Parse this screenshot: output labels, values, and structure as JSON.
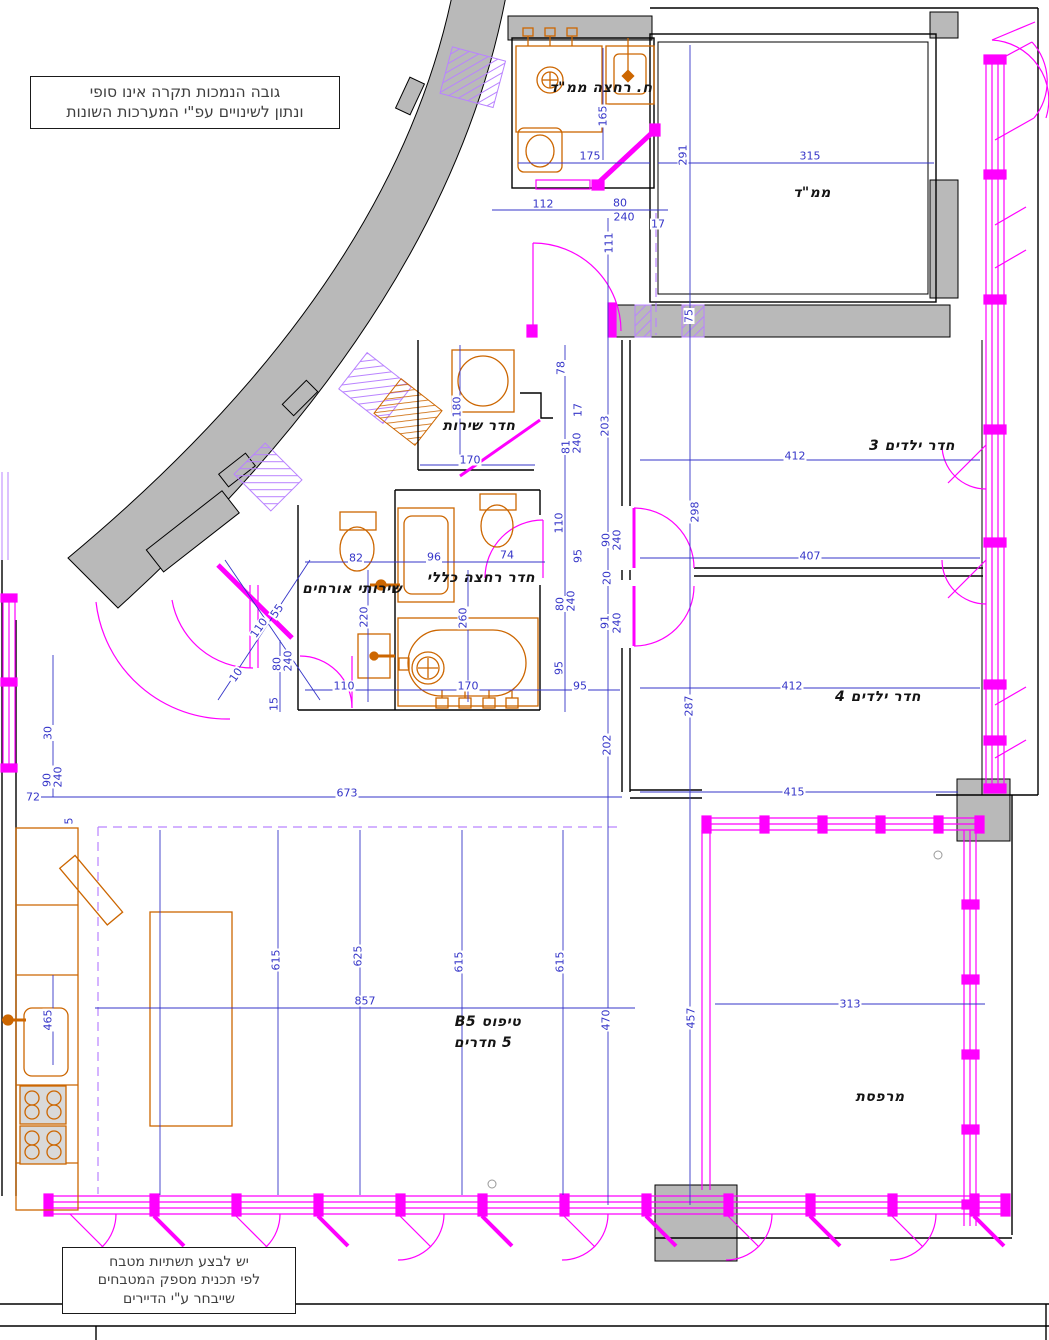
{
  "drawing": {
    "type_label_line1": "טיפוס B5",
    "type_label_line2": "5 חדרים"
  },
  "colors": {
    "dimension_blue": "#3535c8",
    "wall_grey": "#b9b9b9",
    "fixture_orange": "#cc6600",
    "window_magenta": "#ff00ff",
    "hatch_violet": "#b983ff"
  },
  "notes": {
    "ceiling_note": {
      "lines": [
        "גובה הנמכות תקרה אינו סופי",
        "ונתון לשינויים עפ\"י המערכות השונות"
      ]
    },
    "kitchen_note": {
      "lines": [
        "יש לבצע תשתיות מטבח",
        "לפי תכנית מספק המטבחים",
        "שייבחר ע\"י הדיירים"
      ]
    }
  },
  "room_labels": [
    {
      "id": "bath-mamad",
      "label": "ח. רחצה ממ\"ד",
      "x": 601,
      "y": 88
    },
    {
      "id": "mamad",
      "label": "ממ\"ד",
      "x": 812,
      "y": 193
    },
    {
      "id": "service",
      "label": "חדר שירות",
      "x": 479,
      "y": 426
    },
    {
      "id": "kids3",
      "label": "חדר ילדים 3",
      "x": 912,
      "y": 446
    },
    {
      "id": "guest-wc",
      "label": "שירותי אורחים",
      "x": 352,
      "y": 589
    },
    {
      "id": "bath-main",
      "label": "חדר רחצה כללי",
      "x": 481,
      "y": 578
    },
    {
      "id": "kids4",
      "label": "חדר ילדים 4",
      "x": 878,
      "y": 697
    },
    {
      "id": "type-1",
      "label": "טיפוס B5",
      "x": 488,
      "y": 1022
    },
    {
      "id": "type-2",
      "label": "5 חדרים",
      "x": 483,
      "y": 1043
    },
    {
      "id": "balcony",
      "label": "מרפסת",
      "x": 880,
      "y": 1097
    }
  ],
  "dimensions": [
    {
      "t": "165",
      "x": 603,
      "y": 116,
      "r": -90
    },
    {
      "t": "175",
      "x": 590,
      "y": 156
    },
    {
      "t": "291",
      "x": 683,
      "y": 155,
      "r": -90
    },
    {
      "t": "315",
      "x": 810,
      "y": 156
    },
    {
      "t": "112",
      "x": 543,
      "y": 204
    },
    {
      "t": "80",
      "x": 620,
      "y": 203
    },
    {
      "t": "240",
      "x": 624,
      "y": 217
    },
    {
      "t": "17",
      "x": 658,
      "y": 224
    },
    {
      "t": "111",
      "x": 609,
      "y": 243,
      "r": -90
    },
    {
      "t": "75",
      "x": 689,
      "y": 316,
      "r": -90
    },
    {
      "t": "78",
      "x": 561,
      "y": 368,
      "r": -90
    },
    {
      "t": "17",
      "x": 578,
      "y": 410,
      "r": -90
    },
    {
      "t": "180",
      "x": 457,
      "y": 407,
      "r": -90
    },
    {
      "t": "203",
      "x": 605,
      "y": 426,
      "r": -90
    },
    {
      "t": "81",
      "x": 566,
      "y": 447,
      "r": -90
    },
    {
      "t": "240",
      "x": 577,
      "y": 443,
      "r": -90
    },
    {
      "t": "170",
      "x": 470,
      "y": 460
    },
    {
      "t": "412",
      "x": 795,
      "y": 456
    },
    {
      "t": "298",
      "x": 695,
      "y": 512,
      "r": -90
    },
    {
      "t": "110",
      "x": 559,
      "y": 523,
      "r": -90
    },
    {
      "t": "90",
      "x": 606,
      "y": 540,
      "r": -90
    },
    {
      "t": "240",
      "x": 617,
      "y": 540,
      "r": -90
    },
    {
      "t": "95",
      "x": 578,
      "y": 556,
      "r": -90
    },
    {
      "t": "20",
      "x": 607,
      "y": 578,
      "r": -90
    },
    {
      "t": "80",
      "x": 560,
      "y": 604,
      "r": -90
    },
    {
      "t": "240",
      "x": 571,
      "y": 601,
      "r": -90
    },
    {
      "t": "91",
      "x": 605,
      "y": 622,
      "r": -90
    },
    {
      "t": "240",
      "x": 617,
      "y": 623,
      "r": -90
    },
    {
      "t": "95",
      "x": 559,
      "y": 668,
      "r": -90
    },
    {
      "t": "95",
      "x": 580,
      "y": 686
    },
    {
      "t": "407",
      "x": 810,
      "y": 556
    },
    {
      "t": "82",
      "x": 356,
      "y": 558
    },
    {
      "t": "96",
      "x": 434,
      "y": 557
    },
    {
      "t": "74",
      "x": 507,
      "y": 555
    },
    {
      "t": "220",
      "x": 364,
      "y": 617,
      "r": -90
    },
    {
      "t": "260",
      "x": 463,
      "y": 618,
      "r": -90
    },
    {
      "t": "110",
      "x": 344,
      "y": 686
    },
    {
      "t": "170",
      "x": 468,
      "y": 686
    },
    {
      "t": "412",
      "x": 792,
      "y": 686
    },
    {
      "t": "287",
      "x": 689,
      "y": 706,
      "r": -90
    },
    {
      "t": "202",
      "x": 607,
      "y": 745,
      "r": -90
    },
    {
      "t": "673",
      "x": 347,
      "y": 793
    },
    {
      "t": "415",
      "x": 794,
      "y": 792
    },
    {
      "t": "313",
      "x": 850,
      "y": 1004
    },
    {
      "t": "857",
      "x": 365,
      "y": 1001
    },
    {
      "t": "615",
      "x": 276,
      "y": 960,
      "r": -90
    },
    {
      "t": "625",
      "x": 358,
      "y": 956,
      "r": -90
    },
    {
      "t": "615",
      "x": 459,
      "y": 962,
      "r": -90
    },
    {
      "t": "615",
      "x": 560,
      "y": 962,
      "r": -90
    },
    {
      "t": "470",
      "x": 606,
      "y": 1020,
      "r": -90
    },
    {
      "t": "457",
      "x": 691,
      "y": 1018,
      "r": -90
    },
    {
      "t": "465",
      "x": 48,
      "y": 1020,
      "r": -90
    },
    {
      "t": "30",
      "x": 48,
      "y": 733,
      "r": -90
    },
    {
      "t": "90",
      "x": 47,
      "y": 780,
      "r": -90
    },
    {
      "t": "240",
      "x": 58,
      "y": 777,
      "r": -90
    },
    {
      "t": "72",
      "x": 33,
      "y": 797
    },
    {
      "t": "15",
      "x": 274,
      "y": 704,
      "r": -90
    },
    {
      "t": "5",
      "x": 69,
      "y": 821,
      "r": -90
    },
    {
      "t": "55",
      "x": 277,
      "y": 611,
      "r": -55
    },
    {
      "t": "110",
      "x": 259,
      "y": 628,
      "r": -55
    },
    {
      "t": "80",
      "x": 277,
      "y": 664,
      "r": -90
    },
    {
      "t": "240",
      "x": 288,
      "y": 661,
      "r": -90
    },
    {
      "t": "10",
      "x": 236,
      "y": 675,
      "r": -55
    }
  ]
}
